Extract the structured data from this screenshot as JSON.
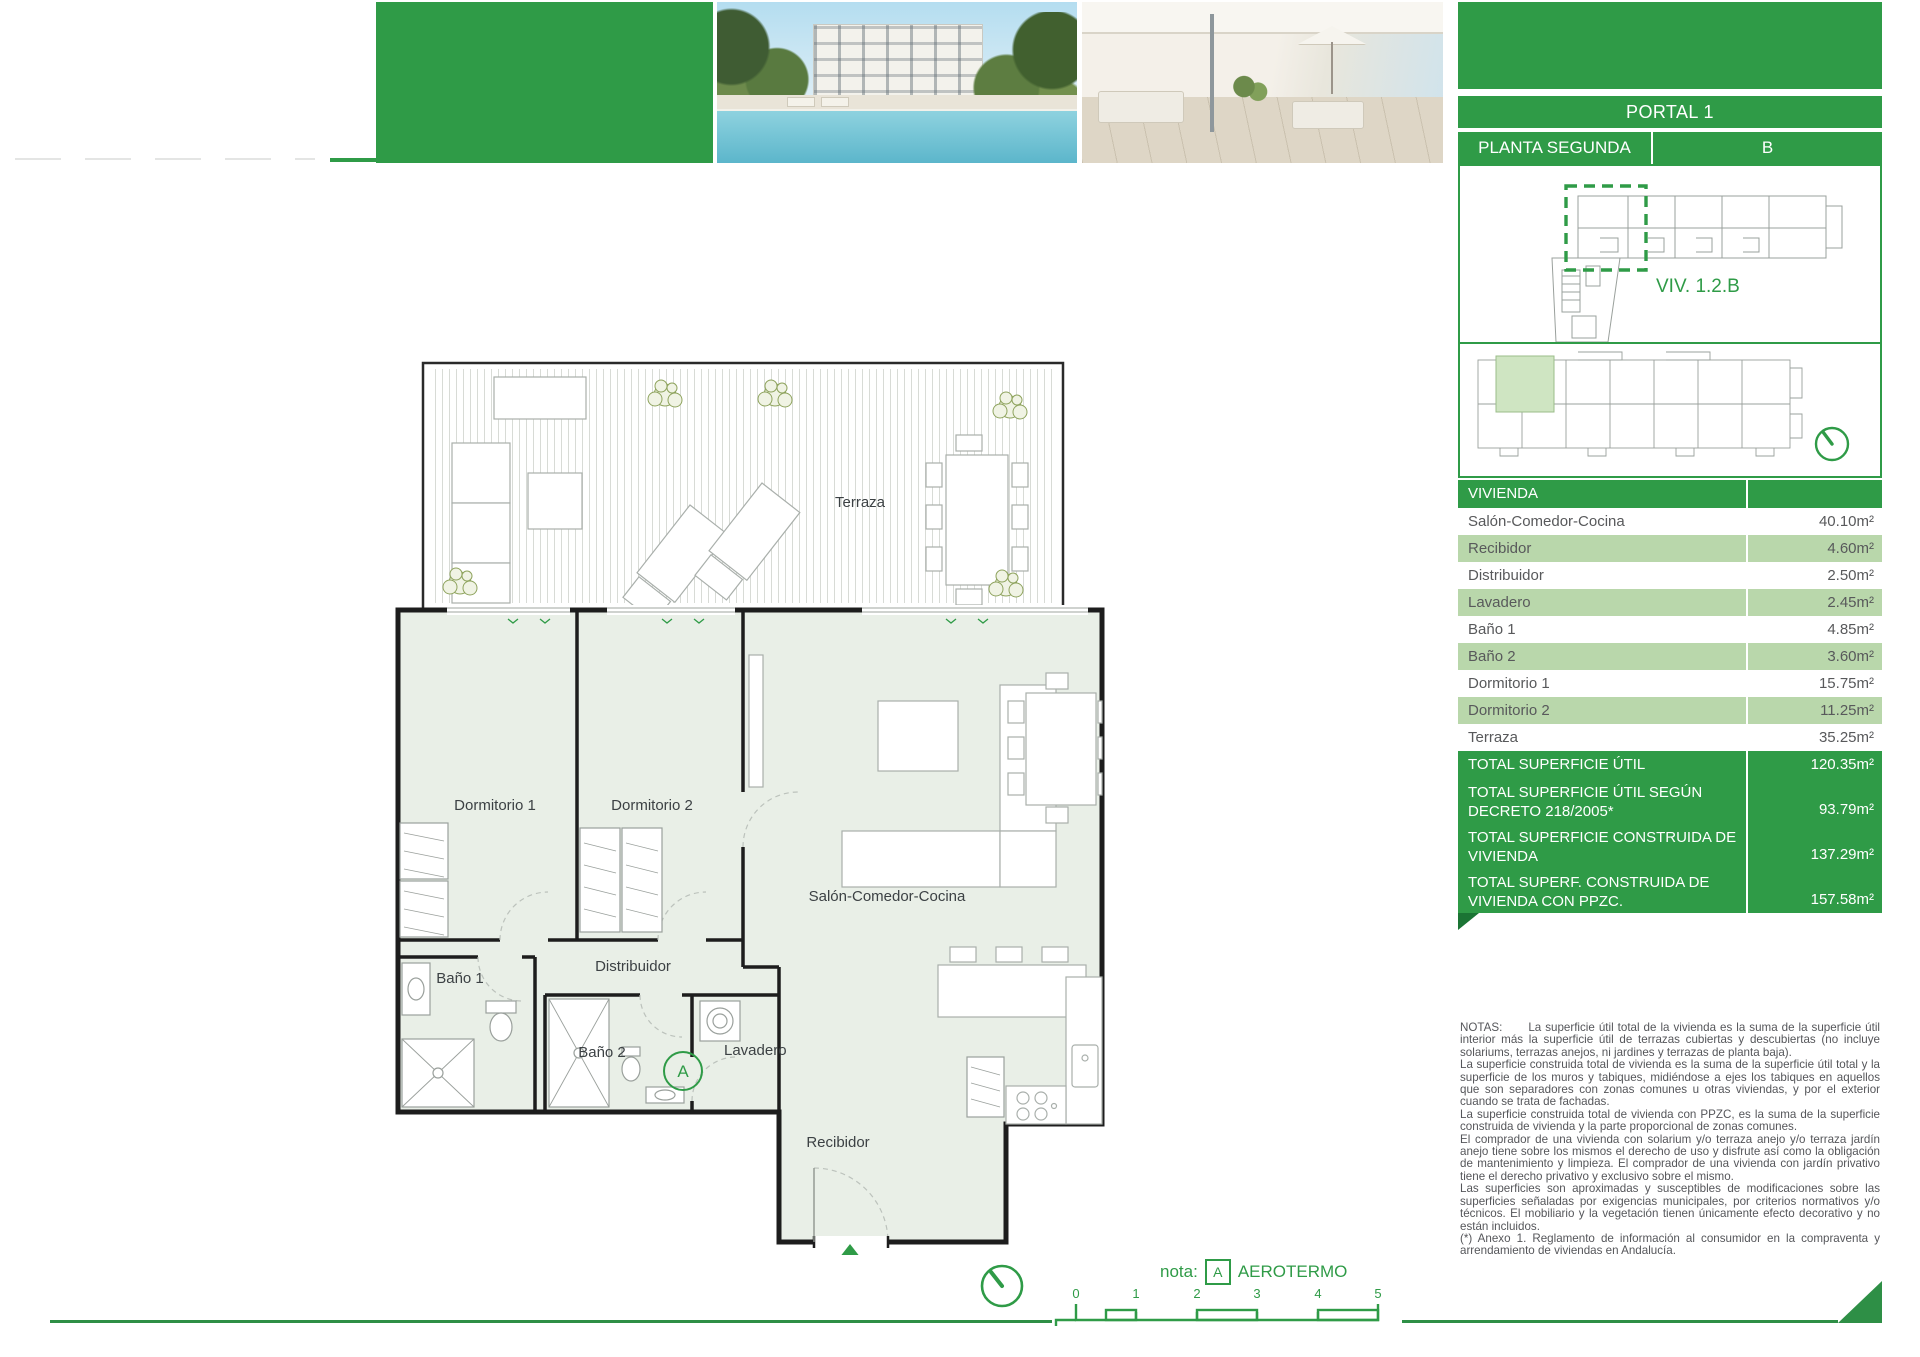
{
  "colors": {
    "green": "#2f9b47",
    "green_dark": "#1b7434",
    "row_green": "#b9d7ab",
    "unit_highlight": "#cfe5c2",
    "text_gray": "#58595b"
  },
  "header": {
    "portal": "PORTAL 1",
    "floor": "PLANTA SEGUNDA",
    "unit": "B"
  },
  "site_plan": {
    "unit_label": "VIV. 1.2.B"
  },
  "surfaces": {
    "header": "VIVIENDA",
    "rows": [
      {
        "label": "Salón-Comedor-Cocina",
        "value": "40.10m²"
      },
      {
        "label": "Recibidor",
        "value": "4.60m²"
      },
      {
        "label": "Distribuidor",
        "value": "2.50m²"
      },
      {
        "label": "Lavadero",
        "value": "2.45m²"
      },
      {
        "label": "Baño 1",
        "value": "4.85m²"
      },
      {
        "label": "Baño 2",
        "value": "3.60m²"
      },
      {
        "label": "Dormitorio 1",
        "value": "15.75m²"
      },
      {
        "label": "Dormitorio 2",
        "value": "11.25m²"
      },
      {
        "label": "Terraza",
        "value": "35.25m²"
      }
    ],
    "totals": [
      {
        "label": "TOTAL SUPERFICIE ÚTIL",
        "value": "120.35m²"
      },
      {
        "label": "TOTAL SUPERFICIE ÚTIL SEGÚN DECRETO 218/2005*",
        "value": "93.79m²"
      },
      {
        "label": "TOTAL SUPERFICIE CONSTRUIDA DE VIVIENDA",
        "value": "137.29m²"
      },
      {
        "label": "TOTAL SUPERF. CONSTRUIDA DE VIVIENDA CON PPZC.",
        "value": "157.58m²"
      }
    ]
  },
  "plan": {
    "labels": {
      "terraza": "Terraza",
      "dormitorio1": "Dormitorio 1",
      "dormitorio2": "Dormitorio 2",
      "salon": "Salón-Comedor-Cocina",
      "distribuidor": "Distribuidor",
      "bano1": "Baño 1",
      "bano2": "Baño 2",
      "lavadero": "Lavadero",
      "recibidor": "Recibidor"
    },
    "aerotermo_mark": "A"
  },
  "footer": {
    "nota_label": "nota:",
    "aerotermo_mark": "A",
    "aerotermo_text": "AEROTERMO",
    "scale_ticks": [
      "0",
      "1",
      "2",
      "3",
      "4",
      "5"
    ]
  },
  "notes": {
    "title": "NOTAS:",
    "paragraphs": [
      "La superficie útil total de la vivienda es la suma de la superficie útil interior más la superficie útil de terrazas cubiertas y descubiertas (no incluye solariums, terrazas anejos, ni jardines y terrazas de planta baja).",
      "La superficie construida total de vivienda es la suma de la superficie útil total y la superficie de los muros y tabiques, midiéndose a ejes los tabiques en aquellos que son separadores con zonas comunes u otras viviendas, y por el exterior cuando se trata de fachadas.",
      "La superficie construida total de vivienda con PPZC, es la suma de la superficie construida de vivienda y la parte proporcional de zonas comunes.",
      "El comprador de una vivienda con solarium y/o terraza anejo y/o terraza jardín anejo tiene sobre los mismos el derecho de uso y disfrute así como la obligación de mantenimiento y limpieza. El comprador de una vivienda con jardín privativo tiene el derecho privativo y exclusivo sobre el mismo.",
      "Las superficies son aproximadas y susceptibles de modificaciones sobre las superficies señaladas por exigencias municipales, por criterios normativos y/o técnicos. El mobiliario y la vegetación tienen únicamente efecto decorativo y no están incluidos.",
      "(*) Anexo 1. Reglamento de información al consumidor en la compraventa y arrendamiento de viviendas en Andalucía."
    ]
  }
}
